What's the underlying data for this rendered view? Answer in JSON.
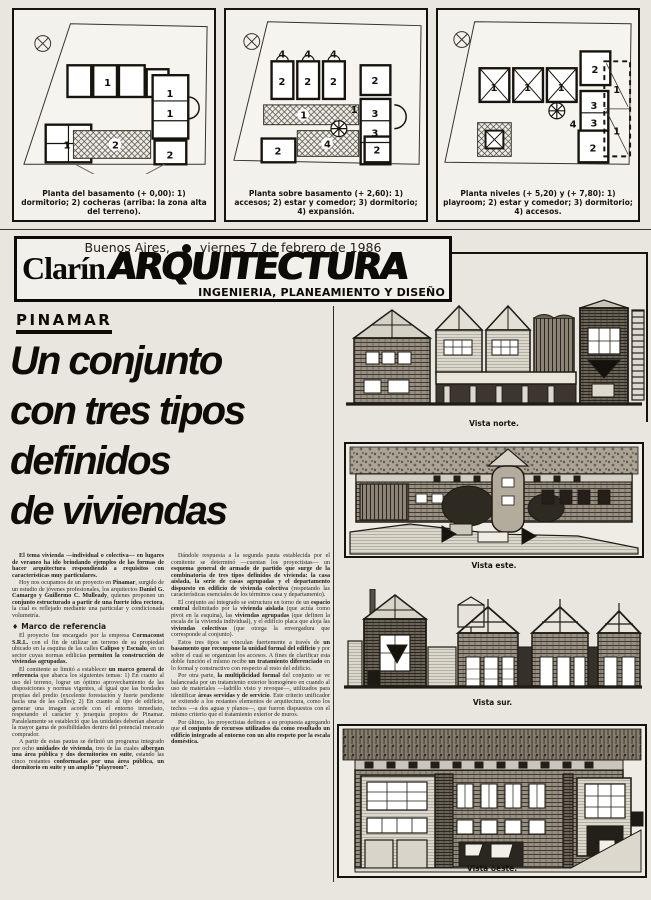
{
  "masthead": {
    "dateline_city": "Buenos Aires,",
    "dateline_date": "viernes 7 de febrero de 1986",
    "brand": "Clarín",
    "section_logo": "ARQUITECTURA",
    "tagline": "INGENIERIA, PLANEAMIENTO Y DISEÑO"
  },
  "plans": [
    {
      "caption": "Planta del basamento (+ 0,00): 1) dormitorio; 2) cocheras (arriba: la zona alta del terreno).",
      "unit_labels": [
        "1",
        "1",
        "1",
        "2",
        "1",
        "2"
      ]
    },
    {
      "caption": "Planta sobre basamento (+ 2,60): 1) accesos; 2) estar y comedor; 3) dormitorio; 4) expansión.",
      "unit_labels": [
        "4",
        "4",
        "4",
        "2",
        "2",
        "2",
        "1",
        "2",
        "1",
        "3",
        "3",
        "4",
        "2",
        "2"
      ]
    },
    {
      "caption": "Planta niveles (+ 5,20) y (+ 7,80): 1) playroom; 2) estar y comedor; 3) dormitorio; 4) accesos.",
      "unit_labels": [
        "1",
        "1",
        "1",
        "2",
        "3",
        "3",
        "4",
        "2",
        "1",
        "1"
      ]
    }
  ],
  "article": {
    "kicker": "PINAMAR",
    "headline_lines": [
      "Un conjunto",
      "con tres tipos",
      "definidos",
      "de viviendas"
    ],
    "col1": [
      {
        "lead": true,
        "runs": [
          {
            "t": "El tema vivienda —individual o colectiva— en lugares de veraneo ha ido brindando ejemplos de las formas de hacer arquitectura respondiendo a requisitos con características muy particulares."
          }
        ]
      },
      {
        "runs": [
          {
            "t": "Hoy nos ocupamos de un proyecto en "
          },
          {
            "b": 1,
            "t": "Pinamar"
          },
          {
            "t": ", surgido de un estudio de jóvenes profesionales, los arquitectos "
          },
          {
            "b": 1,
            "t": "Daniel G. Camargo y Guillermo C. Mulleady"
          },
          {
            "t": ", quienes proponen un "
          },
          {
            "b": 1,
            "t": "conjunto estructurado a partir de una fuerte idea rectora"
          },
          {
            "t": ", la cual es reflejado mediante una particular y condicionada volumetría."
          }
        ]
      },
      {
        "h": "Marco de referencia"
      },
      {
        "runs": [
          {
            "t": "El proyecto fue encargado por la empresa "
          },
          {
            "b": 1,
            "t": "Cormaconst S.R.L."
          },
          {
            "t": " con el fin de utilizar un terreno de su propiedad ubicado en la esquina de las calles "
          },
          {
            "b": 1,
            "t": "Calipso y Escualo"
          },
          {
            "t": ", en un sector cuyas normas edilicias "
          },
          {
            "b": 1,
            "t": "permiten la construcción de viviendas agrupadas."
          }
        ]
      },
      {
        "runs": [
          {
            "t": "El comitente se limitó a establecer "
          },
          {
            "b": 1,
            "t": "un marco general de referencia"
          },
          {
            "t": " que abarca los siguientes temas: 1) En cuanto al uso del terreno, lograr un óptimo aprovechamiento de las disposiciones y normas vigentes, al igual que las bondades propias del predio (excelente forestación y fuerte pendiente hacia una de las calles); 2) En cuanto al tipo de edificio, generar una imagen acorde con el entorno inmediato, respetando el carácter y jerarquía propios de Pinamar. Paralelamente se estableció que las unidades deberían abarcar la mayor gama de posibilidades dentro del potencial mercado comprador."
          }
        ]
      },
      {
        "runs": [
          {
            "t": "A partir de estas pautas se definió un programa integrado por ocho "
          },
          {
            "b": 1,
            "t": "unidades de vivienda"
          },
          {
            "t": ", tres de las cuales "
          },
          {
            "b": 1,
            "t": "albergan una área pública y dos dormitorios en suite"
          },
          {
            "t": ", estando las cinco restantes "
          },
          {
            "b": 1,
            "t": "conformadas por una área pública, un dormitorio en suite y un amplio “playroom”."
          }
        ]
      }
    ],
    "col2": [
      {
        "runs": [
          {
            "t": "Dándole respuesta a la segunda pauta establecida por el comitente se determinó —cuentan los proyectistas— un "
          },
          {
            "b": 1,
            "t": "esquema general de armado de partido que surge de la combinatoria de tres tipos definidos de vivienda: la casa aislada, la serie de casas agrupadas y el departamento dispuesto en edificio de vivienda colectiva"
          },
          {
            "t": " (respetando las características esenciales de los términos casa y departamento)."
          }
        ]
      },
      {
        "runs": [
          {
            "t": "El conjunto así integrado se estructura en torno de un "
          },
          {
            "b": 1,
            "t": "espacio central"
          },
          {
            "t": " delimitado por la "
          },
          {
            "b": 1,
            "t": "vivienda aislada"
          },
          {
            "t": " (que actúa como pivot en la esquina), las "
          },
          {
            "b": 1,
            "t": "viviendas agrupadas"
          },
          {
            "t": " (que definen la escala de la vivienda individual), y el edificio placa que aloja las "
          },
          {
            "b": 1,
            "t": "viviendas colectivas"
          },
          {
            "t": " (que otorga la envergadura que corresponde al conjunto)."
          }
        ]
      },
      {
        "runs": [
          {
            "t": "Estos tres tipos se vinculan fuertemente a través de "
          },
          {
            "b": 1,
            "t": "un basamento que recompone la unidad formal del edificio"
          },
          {
            "t": " y por sobre el cual se organizan los accesos. A fines de clarificar esta doble función el mismo recibe "
          },
          {
            "b": 1,
            "t": "un tratamiento diferenciado"
          },
          {
            "t": " en lo formal y constructivo con respecto al resto del edificio."
          }
        ]
      },
      {
        "runs": [
          {
            "t": "Por otra parte, "
          },
          {
            "b": 1,
            "t": "la multiplicidad formal"
          },
          {
            "t": " del conjunto se ve balanceada por un tratamiento exterior homogéneo en cuando al uso de materiales —ladrillo visto y revoque—, utilizados para identificar "
          },
          {
            "b": 1,
            "t": "áreas servidas y de servicio"
          },
          {
            "t": ". Este criterio unificador se extiende a los restantes elementos de arquitectura, como los techos —a dos aguas y planos—, que fueron dispuestos con el mismo criterio que el tratamiento exterior de muros."
          }
        ]
      },
      {
        "runs": [
          {
            "t": "Por último, los proyectistas definen a su propuesta agregando que "
          },
          {
            "b": 1,
            "t": "el conjunto de recursos utilizados da como resultado un edificio integrado al entorno con un alto respeto por la escala doméstica."
          }
        ]
      }
    ]
  },
  "elevations": [
    {
      "caption": "Vista norte."
    },
    {
      "caption": "Vista este."
    },
    {
      "caption": "Vista sur."
    },
    {
      "caption": "Vista oeste."
    }
  ]
}
